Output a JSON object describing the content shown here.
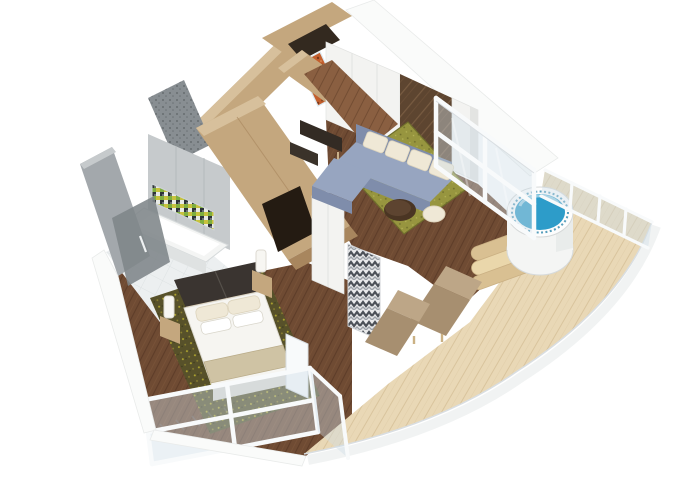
{
  "scene": {
    "type": "isometric-3d-floorplan-render",
    "subject": "suite-with-wraparound-balcony",
    "background": "#ffffff"
  },
  "rooms": [
    {
      "name": "entry-hall",
      "features": [
        "entry-doorway",
        "oak-beam-walls",
        "orange-art-glass-panel",
        "console-table",
        "bench"
      ]
    },
    {
      "name": "living-room",
      "features": [
        "white-panel-wall",
        "dark-marble-accent-wall",
        "sectional-sofa",
        "sofa-cushions-x4",
        "round-coffee-table",
        "olive-area-rug",
        "cream-pouf",
        "dark-wood-plank-floor"
      ]
    },
    {
      "name": "bedroom",
      "features": [
        "double-bed",
        "pillows-x4",
        "beige-foot-runner",
        "dark-headboard-console",
        "nightstands-x2",
        "table-lamps-x2",
        "olive-patterned-carpet",
        "white-wardrobe",
        "chevron-curtain",
        "white-corner-post"
      ]
    },
    {
      "name": "bathroom",
      "features": [
        "bathtub",
        "mosaic-tile-band",
        "glass-shower-enclosure",
        "gray-tile-walls",
        "white-tile-floor"
      ]
    },
    {
      "name": "balcony",
      "features": [
        "round-hot-tub",
        "blue-water",
        "wooden-steps-x3",
        "sun-loungers-x2",
        "light-teak-decking",
        "white-framed-glass-railings",
        "curved-hull-edge"
      ]
    }
  ],
  "counts": {
    "pillows": 4,
    "sofa_cushions": 4,
    "sun_loungers": 2,
    "hot_tub_steps": 3,
    "nightstands": 2,
    "lamps": 2
  },
  "colors": {
    "background": "#ffffff",
    "woodWallLight": "#d7c09c",
    "woodWallMid": "#c4a77e",
    "woodWallDark": "#a8865e",
    "doorDark": "#33291f",
    "closetDark": "#241b12",
    "woodFloorDark": "#6f4b33",
    "woodFloorMid": "#8a5f41",
    "plankLine": "#5a3a27",
    "deckLight": "#e9d8b6",
    "deckLine": "#d8c29a",
    "grayWallLight": "#c6cacc",
    "grayWallMid": "#a3a8ac",
    "grayWallDark": "#888e92",
    "grayWallDarker": "#7e8589",
    "whiteWall": "#f3f3f1",
    "whiteWallShade": "#e3e4e2",
    "cutWhite": "#fafbfa",
    "marbleDark": "#5d4530",
    "marbleVein": "#8a6b4c",
    "artOrange": "#c35f2d",
    "artOrangeDark": "#7e3a1a",
    "sofaBlue": "#97a5c0",
    "sofaBlueDark": "#7f8dab",
    "cushionCream": "#efe8d6",
    "rugOlive": "#97953f",
    "rugOliveDark": "#6f6e2c",
    "carpetOlive": "#57512a",
    "carpetSpeck": "#b0a62e",
    "bedWhite": "#f6f5f1",
    "bedShade": "#dcdad3",
    "runnerBeige": "#cfc3a4",
    "headboardDark": "#3a3430",
    "tubWhite": "#f4f5f4",
    "tubShade": "#dfe2e2",
    "waterBlue": "#2d9cc9",
    "waterBlueDark": "#1f7ea6",
    "stepWood": "#d9c092",
    "stepWoodLight": "#ead7ab",
    "loungerTan": "#a78f70",
    "loungerTanLight": "#bda687",
    "railWhite": "#f8fafb",
    "railShade": "#d9dee2",
    "glassTint": "#cfdde6",
    "mosaicGreen": "#7fae3f",
    "mosaicYellow": "#c8c23e",
    "mosaicDark": "#2e3338",
    "floorTileWhite": "#eceff0",
    "tileLine": "#dde2e3",
    "tableBrown": "#4a3523",
    "benchDark": "#332b24"
  }
}
